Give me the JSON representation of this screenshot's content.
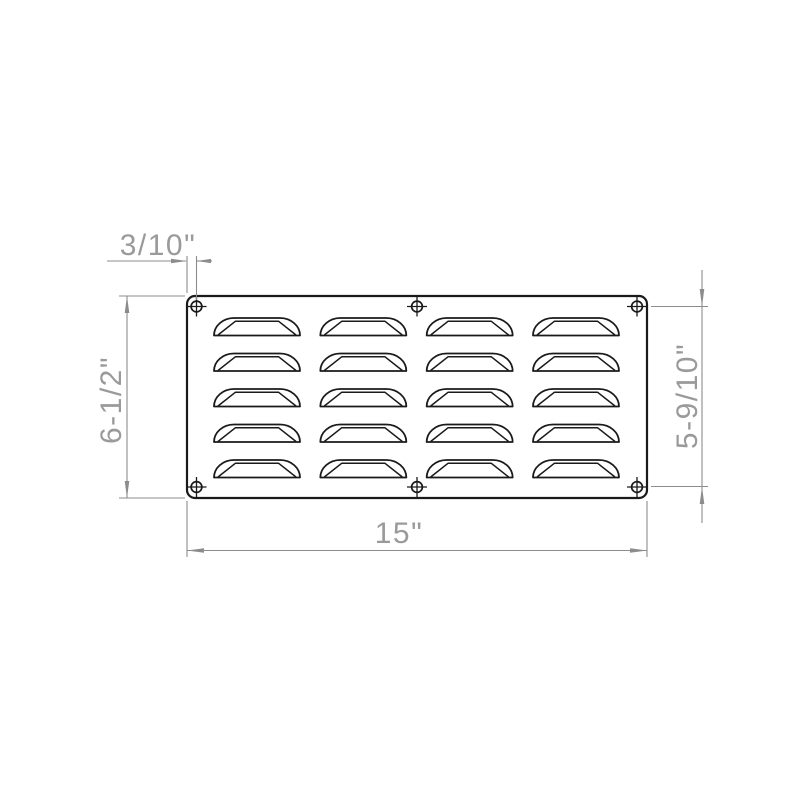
{
  "drawing": {
    "type": "technical-drawing",
    "part_name": "louvered-vent-panel",
    "dimensions": {
      "overall_width": "15\"",
      "overall_height": "6-1/2\"",
      "hole_spacing_vertical": "5-9/10\"",
      "hole_edge_offset": "3/10\""
    },
    "louver_grid": {
      "rows": 5,
      "columns": 4
    },
    "screw_holes": {
      "count": 6
    },
    "colors": {
      "outline": "#1a1a1a",
      "dimension_line": "#8c8c8c",
      "dimension_text": "#9a9a9a",
      "background": "#ffffff"
    }
  }
}
